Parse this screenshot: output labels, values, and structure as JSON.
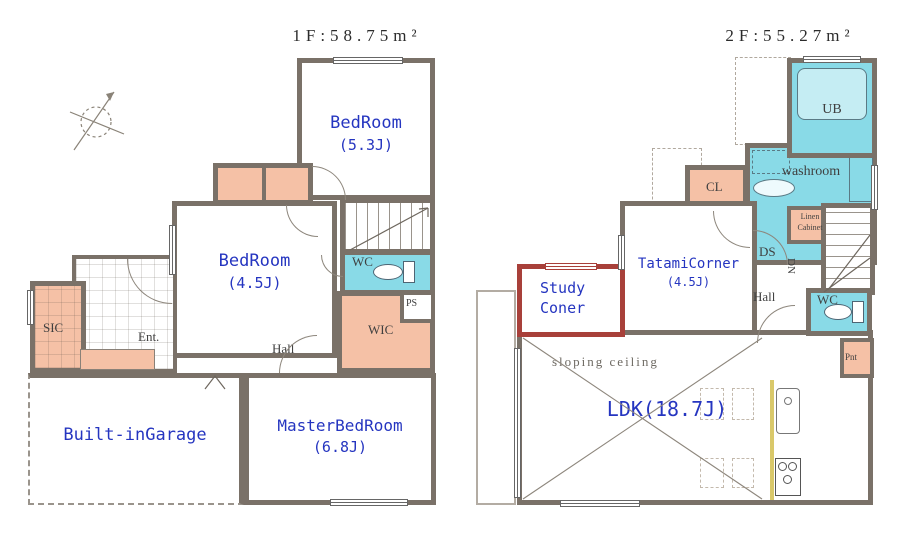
{
  "floor1": {
    "title": "1F:58.75m²",
    "rooms": {
      "bedroom53": {
        "name": "BedRoom",
        "area": "(5.3J)"
      },
      "bedroom45": {
        "name": "BedRoom",
        "area": "(4.5J)"
      },
      "wc": {
        "name": "WC"
      },
      "ps": {
        "name": "PS"
      },
      "wic": {
        "name": "WIC"
      },
      "hall": {
        "name": "Hall"
      },
      "ent": {
        "name": "Ent."
      },
      "sic": {
        "name": "SIC"
      },
      "garage": {
        "name": "Built-inGarage"
      },
      "master": {
        "name": "MasterBedRoom",
        "area": "(6.8J)"
      }
    }
  },
  "floor2": {
    "title": "2F:55.27m²",
    "rooms": {
      "ub": {
        "name": "UB"
      },
      "washroom": {
        "name": "washroom"
      },
      "cl": {
        "name": "CL"
      },
      "linen": {
        "line1": "Linen",
        "line2": "Cabinet"
      },
      "ds": {
        "name": "DS"
      },
      "dn": {
        "name": "DN"
      },
      "tatami": {
        "name": "TatamiCorner",
        "area": "(4.5J)"
      },
      "study": {
        "line1": "Study",
        "line2": "Coner"
      },
      "hall": {
        "name": "Hall"
      },
      "wc": {
        "name": "WC"
      },
      "pnt": {
        "name": "Pnt"
      },
      "ldk": {
        "name": "LDK(18.7J)",
        "note": "sloping ceiling"
      }
    }
  },
  "colors": {
    "wall": "#7a7168",
    "closet_fill": "#f5c1a6",
    "wet_area_fill": "#89dae7",
    "room_label_blue": "#2535c0",
    "study_wall_red": "#a8403a",
    "counter_yellow": "#d9c86a"
  }
}
